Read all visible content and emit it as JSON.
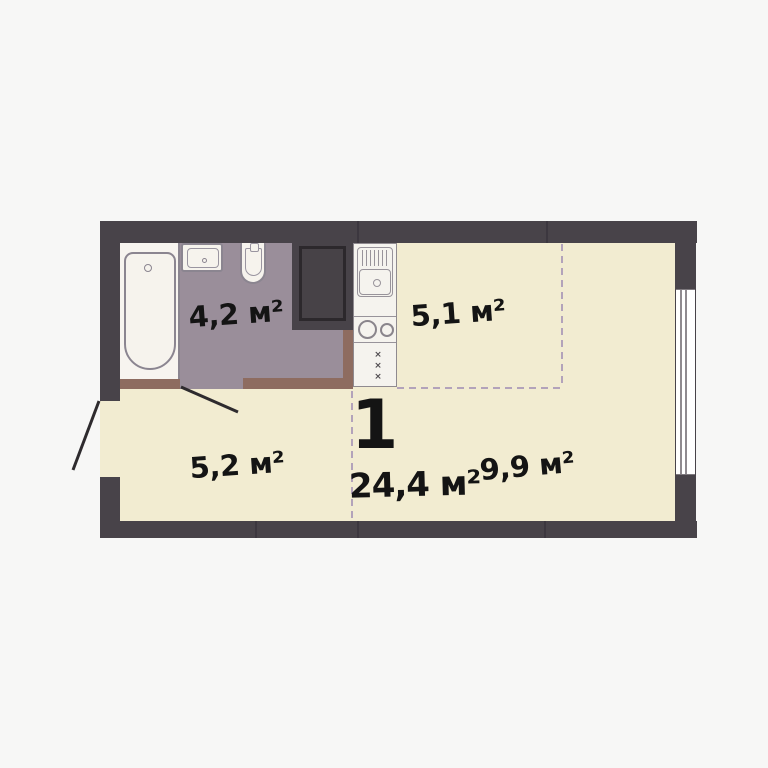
{
  "floor_plan": {
    "summary": {
      "rooms_label": "1",
      "total_area_label": "24,4 м²"
    },
    "zones": {
      "bathroom": {
        "area_label": "4,2 м²"
      },
      "kitchen": {
        "area_label": "5,1 м²"
      },
      "hallway": {
        "area_label": "5,2 м²"
      },
      "living_room": {
        "area_label": "9,9 м²"
      }
    },
    "fixtures": [
      "bathtub",
      "bathroom-sink",
      "toilet",
      "ventilation-shaft",
      "kitchen-sink",
      "cooktop",
      "kitchen-cabinet",
      "window"
    ],
    "doors": [
      "entrance-door-swing",
      "bathroom-door-swing"
    ],
    "kitchen_cabinet_mark": "×",
    "colors": {
      "background": "#f7f7f6",
      "walls": "#484349",
      "floor": "#f2ecd1",
      "bathroom_floor": "#9a8e9a",
      "partition_brown": "#8e6c60",
      "zone_dashed": "#b3a3ba",
      "fixture_white": "#f6f3ed",
      "label_text": "#141414"
    }
  }
}
